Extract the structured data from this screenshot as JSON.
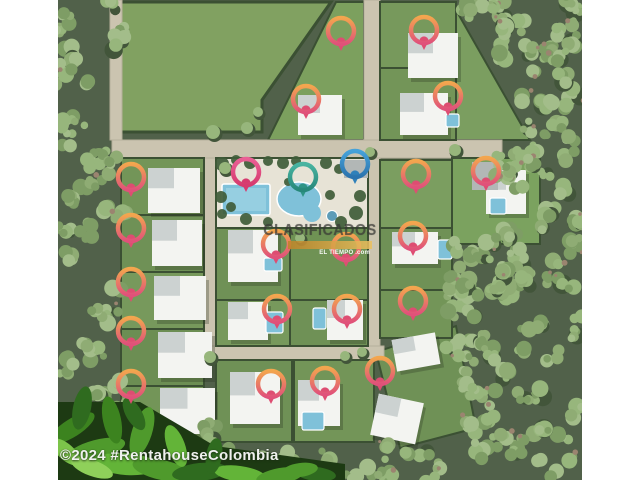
{
  "watermarks": {
    "center": {
      "title": "CLASIFICADOS",
      "bar_text": "EL TIEMPO .com"
    },
    "bottom": {
      "text": "©2024 #RentahouseColombia"
    }
  },
  "palette": {
    "forest_base": "#51614a",
    "tree_colors": [
      "#8fac74",
      "#97b67c",
      "#7e9d65",
      "#a3bd8a"
    ],
    "tree_shadow": "#42553a",
    "ground_dot": "#9b8470",
    "hedge": "#3b5033",
    "road": "#cbc4b0",
    "road_edge": "#b6af9b",
    "deck": "#e7e3d6",
    "house_base": "#f3f4f1",
    "house_wing": "#ccd2d1",
    "house_gray": "#b2b7b6",
    "house_shadow": "rgba(35,45,30,0.28)",
    "pool_water": "#7fc1d9",
    "pool_light": "#a9dbe7",
    "pool_stroke": "#ffffff",
    "leaf_base": "#1d3a13",
    "pins": {
      "warm": {
        "top": "#f3a64e",
        "bottom": "#e0517a",
        "tail": "#de4d72"
      },
      "pink": {
        "top": "#ea5f95",
        "bottom": "#d63a6e",
        "tail": "#d63a6e"
      },
      "teal": {
        "top": "#49b4a1",
        "bottom": "#27887a",
        "tail": "#2e9486"
      },
      "blue": {
        "top": "#46a2d9",
        "bottom": "#2b73ae",
        "tail": "#2f80ba"
      }
    }
  },
  "scene": {
    "photo": {
      "x": 58,
      "y": 0,
      "w": 524,
      "h": 480
    },
    "field": {
      "points": "121,2 331,2 262,100 262,132 121,132",
      "fill": "#81a161"
    },
    "polys": [
      {
        "points": "336,2 364,2 364,140 268,140",
        "fill": "#7ca05e"
      },
      {
        "points": "456,10 530,140 456,140",
        "fill": "#7b9e60"
      },
      {
        "points": "376,352 456,326 476,428 400,448",
        "fill": "#6f9156"
      }
    ],
    "roads": [
      {
        "x": 112,
        "y": 140,
        "w": 390,
        "h": 18
      },
      {
        "x": 364,
        "y": 0,
        "w": 16,
        "h": 140
      },
      {
        "x": 204,
        "y": 158,
        "w": 12,
        "h": 196
      },
      {
        "x": 368,
        "y": 158,
        "w": 12,
        "h": 188
      },
      {
        "x": 204,
        "y": 346,
        "w": 180,
        "h": 14
      },
      {
        "x": 110,
        "y": 0,
        "w": 12,
        "h": 140
      }
    ],
    "lots": [
      {
        "x": 121,
        "y": 158,
        "w": 83,
        "h": 57,
        "c": "#739558"
      },
      {
        "x": 121,
        "y": 215,
        "w": 83,
        "h": 57,
        "c": "#6f9156"
      },
      {
        "x": 121,
        "y": 272,
        "w": 83,
        "h": 57,
        "c": "#77995c"
      },
      {
        "x": 121,
        "y": 329,
        "w": 83,
        "h": 57,
        "c": "#6c8e53"
      },
      {
        "x": 121,
        "y": 386,
        "w": 83,
        "h": 57,
        "c": "#739558"
      },
      {
        "x": 216,
        "y": 228,
        "w": 74,
        "h": 72,
        "c": "#6f9156"
      },
      {
        "x": 290,
        "y": 228,
        "w": 78,
        "h": 72,
        "c": "#6f9254"
      },
      {
        "x": 216,
        "y": 300,
        "w": 74,
        "h": 46,
        "c": "#77995c"
      },
      {
        "x": 290,
        "y": 300,
        "w": 78,
        "h": 46,
        "c": "#6f9156"
      },
      {
        "x": 380,
        "y": 160,
        "w": 72,
        "h": 68,
        "c": "#7b9e60"
      },
      {
        "x": 380,
        "y": 228,
        "w": 72,
        "h": 62,
        "c": "#6f9156"
      },
      {
        "x": 380,
        "y": 290,
        "w": 72,
        "h": 48,
        "c": "#739558"
      },
      {
        "x": 452,
        "y": 158,
        "w": 88,
        "h": 86,
        "c": "#7ba25f"
      },
      {
        "x": 380,
        "y": 2,
        "w": 76,
        "h": 66,
        "c": "#77995c"
      },
      {
        "x": 380,
        "y": 68,
        "w": 76,
        "h": 72,
        "c": "#739558"
      },
      {
        "x": 216,
        "y": 360,
        "w": 76,
        "h": 82,
        "c": "#6f9156"
      },
      {
        "x": 294,
        "y": 360,
        "w": 80,
        "h": 82,
        "c": "#739558"
      }
    ],
    "amenity": {
      "deck": {
        "x": 216,
        "y": 158,
        "w": 152,
        "h": 70
      },
      "lap_pool": {
        "x": 222,
        "y": 184,
        "w": 48,
        "h": 31
      },
      "blob_pool": {
        "cx": 299,
        "cy": 199,
        "rx": 22,
        "ry": 17
      },
      "blob2": {
        "cx": 312,
        "cy": 213,
        "r": 9
      },
      "spa": {
        "cx": 332,
        "cy": 216,
        "r": 5.5
      },
      "greens": [
        [
          222,
          164,
          7
        ],
        [
          236,
          160,
          5
        ],
        [
          250,
          163,
          6
        ],
        [
          268,
          161,
          5
        ],
        [
          283,
          163,
          6
        ],
        [
          296,
          161,
          5
        ],
        [
          326,
          163,
          6
        ],
        [
          339,
          169,
          5
        ],
        [
          360,
          196,
          6
        ],
        [
          356,
          213,
          7
        ],
        [
          341,
          222,
          6
        ],
        [
          268,
          222,
          5
        ],
        [
          246,
          219,
          6
        ],
        [
          231,
          207,
          5
        ],
        [
          221,
          197,
          6
        ],
        [
          288,
          182,
          4
        ],
        [
          330,
          195,
          5
        ],
        [
          222,
          214,
          5
        ]
      ]
    },
    "houses": [
      {
        "x": 408,
        "y": 33,
        "w": 50,
        "h": 45
      },
      {
        "x": 298,
        "y": 95,
        "w": 44,
        "h": 40
      },
      {
        "x": 400,
        "y": 93,
        "w": 48,
        "h": 42
      },
      {
        "x": 148,
        "y": 168,
        "w": 52,
        "h": 45
      },
      {
        "x": 152,
        "y": 220,
        "w": 50,
        "h": 46
      },
      {
        "x": 154,
        "y": 276,
        "w": 52,
        "h": 44
      },
      {
        "x": 158,
        "y": 332,
        "w": 54,
        "h": 46
      },
      {
        "x": 160,
        "y": 388,
        "w": 55,
        "h": 46
      },
      {
        "x": 228,
        "y": 230,
        "w": 50,
        "h": 52
      },
      {
        "x": 486,
        "y": 170,
        "w": 40,
        "h": 44
      },
      {
        "x": 472,
        "y": 162,
        "w": 26,
        "h": 28,
        "gray": true
      },
      {
        "x": 392,
        "y": 232,
        "w": 46,
        "h": 32
      },
      {
        "x": 228,
        "y": 302,
        "w": 40,
        "h": 38
      },
      {
        "x": 327,
        "y": 300,
        "w": 36,
        "h": 40
      },
      {
        "x": 394,
        "y": 336,
        "w": 44,
        "h": 32,
        "rot": -10
      },
      {
        "x": 230,
        "y": 372,
        "w": 50,
        "h": 52
      },
      {
        "x": 298,
        "y": 380,
        "w": 42,
        "h": 46
      },
      {
        "x": 374,
        "y": 398,
        "w": 46,
        "h": 42,
        "rot": 12
      },
      {
        "x": 344,
        "y": 160,
        "w": 24,
        "h": 18,
        "gray": true
      }
    ],
    "pools": [
      {
        "x": 490,
        "y": 198,
        "w": 16,
        "h": 16
      },
      {
        "x": 438,
        "y": 240,
        "w": 14,
        "h": 19
      },
      {
        "x": 266,
        "y": 312,
        "w": 17,
        "h": 21
      },
      {
        "x": 313,
        "y": 308,
        "w": 13,
        "h": 21
      },
      {
        "x": 302,
        "y": 412,
        "w": 22,
        "h": 18
      },
      {
        "x": 446,
        "y": 114,
        "w": 13,
        "h": 13
      },
      {
        "x": 264,
        "y": 258,
        "w": 18,
        "h": 13
      }
    ],
    "forest_patches": [
      {
        "x": 58,
        "y": 0,
        "w": 64,
        "h": 480,
        "n": 60
      },
      {
        "x": 496,
        "y": 0,
        "w": 86,
        "h": 480,
        "n": 85
      },
      {
        "x": 120,
        "y": 425,
        "w": 96,
        "h": 55,
        "n": 12
      },
      {
        "x": 216,
        "y": 446,
        "w": 290,
        "h": 34,
        "n": 24
      },
      {
        "x": 448,
        "y": 240,
        "w": 56,
        "h": 120,
        "n": 26
      },
      {
        "x": 462,
        "y": 350,
        "w": 45,
        "h": 96,
        "n": 16
      },
      {
        "x": 462,
        "y": 0,
        "w": 42,
        "h": 30,
        "n": 7
      }
    ],
    "dev_trees": [
      [
        213,
        132,
        7
      ],
      [
        247,
        128,
        6
      ],
      [
        225,
        168,
        6
      ],
      [
        258,
        112,
        5
      ],
      [
        300,
        238,
        5
      ],
      [
        362,
        352,
        5
      ],
      [
        210,
        357,
        6
      ],
      [
        455,
        150,
        6
      ],
      [
        370,
        152,
        5
      ],
      [
        345,
        356,
        5
      ]
    ],
    "leaves": {
      "base": "58,402 140,402 215,446 345,464 345,480 58,480",
      "items": [
        [
          72,
          428,
          26,
          9,
          -32,
          "#3c831f"
        ],
        [
          96,
          450,
          30,
          10,
          -15,
          "#4f9a2c"
        ],
        [
          126,
          464,
          32,
          11,
          4,
          "#63b438"
        ],
        [
          162,
          470,
          30,
          10,
          12,
          "#4f9a2c"
        ],
        [
          200,
          472,
          28,
          9,
          -6,
          "#2f6b1f"
        ],
        [
          240,
          474,
          26,
          8,
          8,
          "#63b438"
        ],
        [
          280,
          476,
          24,
          8,
          -10,
          "#4f9a2c"
        ],
        [
          316,
          474,
          20,
          7,
          6,
          "#2f6b1f"
        ],
        [
          82,
          408,
          9,
          22,
          12,
          "#2f6b1f"
        ],
        [
          112,
          420,
          9,
          24,
          -12,
          "#3c831f"
        ],
        [
          142,
          432,
          10,
          26,
          18,
          "#4f9a2c"
        ],
        [
          176,
          446,
          9,
          22,
          -20,
          "#63b438"
        ],
        [
          214,
          456,
          8,
          18,
          10,
          "#2f6b1f"
        ],
        [
          66,
          452,
          18,
          8,
          42,
          "#7cc44a"
        ],
        [
          92,
          468,
          22,
          8,
          20,
          "#8fd05a"
        ],
        [
          300,
          470,
          18,
          7,
          -8,
          "#4f9a2c"
        ],
        [
          134,
          414,
          8,
          18,
          -30,
          "#2f6b1f"
        ]
      ]
    },
    "pins": [
      {
        "x": 341,
        "y": 31,
        "v": "warm"
      },
      {
        "x": 424,
        "y": 30,
        "v": "warm"
      },
      {
        "x": 306,
        "y": 99,
        "v": "warm"
      },
      {
        "x": 448,
        "y": 96,
        "v": "warm"
      },
      {
        "x": 131,
        "y": 177,
        "v": "warm"
      },
      {
        "x": 246,
        "y": 172,
        "v": "pink"
      },
      {
        "x": 303,
        "y": 177,
        "v": "teal"
      },
      {
        "x": 355,
        "y": 164,
        "v": "blue"
      },
      {
        "x": 416,
        "y": 174,
        "v": "warm"
      },
      {
        "x": 486,
        "y": 171,
        "v": "warm"
      },
      {
        "x": 131,
        "y": 228,
        "v": "warm"
      },
      {
        "x": 276,
        "y": 244,
        "v": "warm"
      },
      {
        "x": 346,
        "y": 247,
        "v": "warm"
      },
      {
        "x": 413,
        "y": 236,
        "v": "warm"
      },
      {
        "x": 131,
        "y": 282,
        "v": "warm"
      },
      {
        "x": 277,
        "y": 309,
        "v": "warm"
      },
      {
        "x": 347,
        "y": 309,
        "v": "warm"
      },
      {
        "x": 413,
        "y": 301,
        "v": "warm"
      },
      {
        "x": 131,
        "y": 331,
        "v": "warm"
      },
      {
        "x": 131,
        "y": 384,
        "v": "warm"
      },
      {
        "x": 271,
        "y": 384,
        "v": "warm"
      },
      {
        "x": 325,
        "y": 381,
        "v": "warm"
      },
      {
        "x": 380,
        "y": 371,
        "v": "warm"
      }
    ]
  }
}
